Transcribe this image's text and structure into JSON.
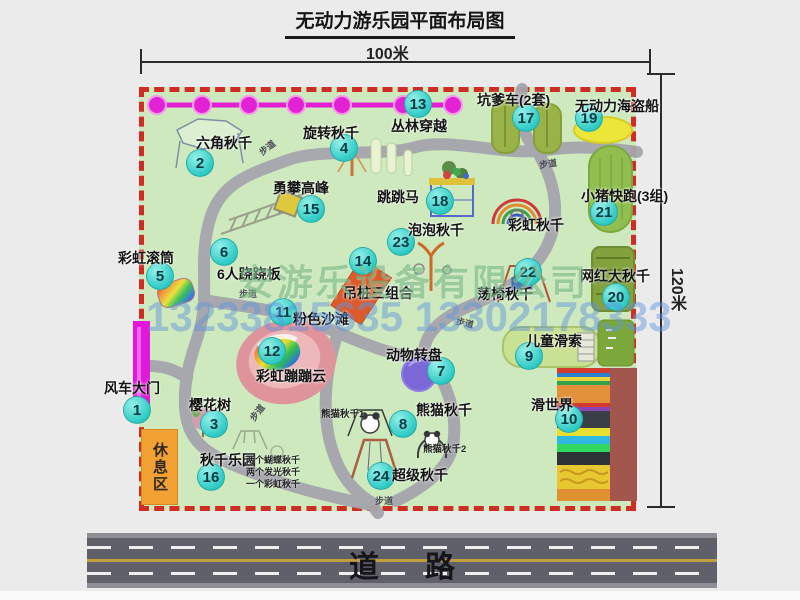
{
  "title": "无动力游乐园平面布局图",
  "dims": {
    "width": "100米",
    "height": "120米"
  },
  "road": {
    "label": "道路"
  },
  "watermark": {
    "company": "安游乐设备有限公司",
    "phones": "13233815635 13302178333"
  },
  "rest_area": "休息区",
  "path_label": "步道",
  "attractions": {
    "a1": {
      "num": "1",
      "name": "风车大门"
    },
    "a2": {
      "num": "2",
      "name": "六角秋千"
    },
    "a3": {
      "num": "3",
      "name": "樱花树"
    },
    "a4": {
      "num": "4",
      "name": "旋转秋千"
    },
    "a5": {
      "num": "5",
      "name": "彩虹滚筒"
    },
    "a6": {
      "num": "6",
      "name": "6人跷跷板"
    },
    "a7": {
      "num": "7",
      "name": "动物转盘"
    },
    "a8": {
      "num": "8",
      "name": "熊猫秋千"
    },
    "a9": {
      "num": "9",
      "name": "儿童滑索"
    },
    "a10": {
      "num": "10",
      "name": "滑世界"
    },
    "a11": {
      "num": "11",
      "name": "粉色沙滩"
    },
    "a12": {
      "num": "12",
      "name": "彩虹蹦蹦云"
    },
    "a13": {
      "num": "13",
      "name": "丛林穿越"
    },
    "a14": {
      "num": "14",
      "name": "吊桩三组合"
    },
    "a15": {
      "num": "15",
      "name": "勇攀高峰"
    },
    "a16": {
      "num": "16",
      "name": "秋千乐园"
    },
    "a17": {
      "num": "17",
      "name": "坑爹车(2套)"
    },
    "a18": {
      "num": "18",
      "name": "跳跳马"
    },
    "a19": {
      "num": "19",
      "name": "无动力海盗船"
    },
    "a20": {
      "num": "20",
      "name": "网红大秋千"
    },
    "a21": {
      "num": "21",
      "name": "小猪快跑(3组)"
    },
    "a22": {
      "num": "22",
      "name": "荡椅秋千"
    },
    "a23": {
      "num": "23",
      "name": "泡泡秋千"
    },
    "a24": {
      "num": "24",
      "name": "超级秋千"
    },
    "rs": {
      "num": "",
      "name": "彩虹秋千"
    }
  },
  "sub_labels": {
    "panda1": "熊猫秋千1",
    "panda2": "熊猫秋千2",
    "swing_list": [
      "两个蝴蝶秋千",
      "两个发光秋千",
      "一个彩虹秋千"
    ]
  },
  "colors": {
    "ground_green": "#cde9bd",
    "border_red": "#cf2d24",
    "badge_teal": "#2cc9c4",
    "jungle_magenta": "#e31fd4",
    "road_gray": "#60606a"
  }
}
